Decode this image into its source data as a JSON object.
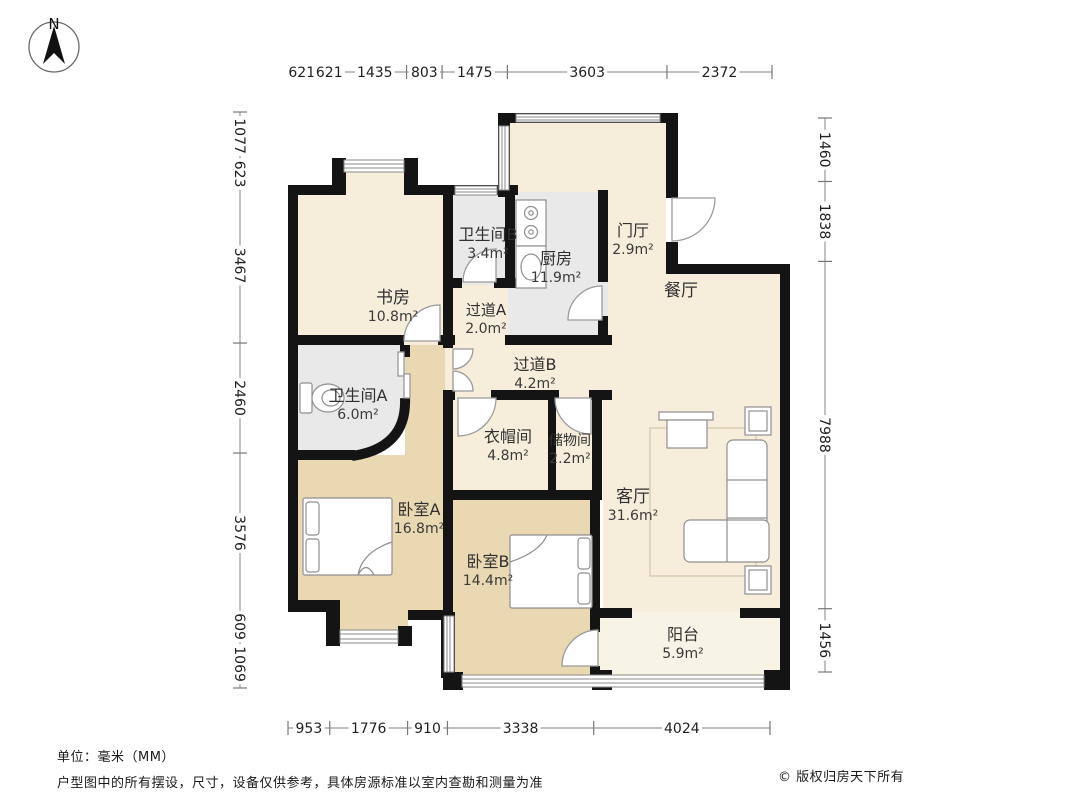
{
  "compass": {
    "n": "N"
  },
  "dimensions": {
    "top": {
      "values": [
        "621",
        "621",
        "1435",
        "803",
        "1475",
        "3603",
        "2372"
      ]
    },
    "left": {
      "values": [
        "1077",
        "623",
        "3467",
        "2460",
        "3576",
        "609",
        "1069"
      ]
    },
    "right": {
      "values": [
        "1460",
        "1838",
        "7988",
        "1456"
      ]
    },
    "bottom": {
      "values": [
        "953",
        "1776",
        "910",
        "3338",
        "4024"
      ]
    }
  },
  "rooms": [
    {
      "id": "study",
      "name": "书房",
      "area": "10.8m²"
    },
    {
      "id": "bath-b",
      "name": "卫生间B",
      "area": "3.4m²"
    },
    {
      "id": "kitchen",
      "name": "厨房",
      "area": "11.9m²"
    },
    {
      "id": "foyer",
      "name": "门厅",
      "area": "2.9m²"
    },
    {
      "id": "dining",
      "name": "餐厅",
      "area": ""
    },
    {
      "id": "hall-a",
      "name": "过道A",
      "area": "2.0m²"
    },
    {
      "id": "hall-b",
      "name": "过道B",
      "area": "4.2m²"
    },
    {
      "id": "bath-a",
      "name": "卫生间A",
      "area": "6.0m²"
    },
    {
      "id": "cloakroom",
      "name": "衣帽间",
      "area": "4.8m²"
    },
    {
      "id": "storage",
      "name": "储物间",
      "area": "2.2m²"
    },
    {
      "id": "living",
      "name": "客厅",
      "area": "31.6m²"
    },
    {
      "id": "bedroom-a",
      "name": "卧室A",
      "area": "16.8m²"
    },
    {
      "id": "bedroom-b",
      "name": "卧室B",
      "area": "14.4m²"
    },
    {
      "id": "balcony",
      "name": "阳台",
      "area": "5.9m²"
    }
  ],
  "footer": {
    "unit_note": "单位：毫米（MM）",
    "disclaimer": "户型图中的所有摆设，尺寸，设备仅供参考，具体房源标准以室内查勘和测量为准",
    "copyright": "© 版权归房天下所有"
  },
  "colors": {
    "floor_main": "#f6eedb",
    "floor_bedroom": "#ead8b2",
    "floor_wet": "#e9e9e9",
    "floor_balcony": "#f7f4e6",
    "wall": "#141414"
  }
}
